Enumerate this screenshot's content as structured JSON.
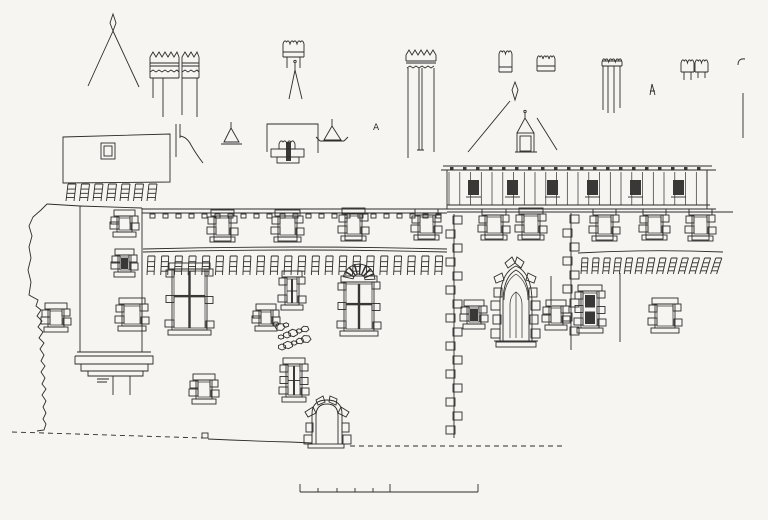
{
  "sheet": {
    "background": "#f6f5f2",
    "ink": "#2e2c2a",
    "dark": "#3a3836",
    "kind": "architectural-elevation-line-drawing"
  },
  "drawing": {
    "annotation": {
      "label": "A"
    },
    "scale_bar": {
      "y": 492,
      "x_start": 300,
      "x_end": 478,
      "major_ticks": [
        300,
        390,
        478
      ],
      "minor_ticks": [
        318,
        337,
        355,
        373
      ],
      "major_height": 8,
      "minor_height": 4
    },
    "dentils": {
      "x": 150,
      "y": 214,
      "count": 23,
      "spacing": 13,
      "w": 5,
      "h": 4
    },
    "corbel_rows": [
      {
        "name": "tower-machicolation",
        "x": 66,
        "y": 184,
        "count": 7,
        "spacing": 13.5,
        "w": 8,
        "h": 17,
        "lean": 2,
        "lean_step": 0
      },
      {
        "name": "left-machicolation",
        "x": 147,
        "y": 256,
        "count": 22,
        "spacing": 13.7,
        "w": 7,
        "h": 19,
        "lean": 1,
        "lean_step": 0
      },
      {
        "name": "right-machicolation",
        "x": 581,
        "y": 258,
        "count": 13,
        "spacing": 10.8,
        "w": 6,
        "h": 16,
        "lean": 1,
        "lean_step": 0.35
      }
    ],
    "gallery": {
      "x": 447,
      "end_x": 712,
      "top_line_1": 166,
      "top_line_2": 170,
      "post_top": 172,
      "post_bottom": 205,
      "posts": 25,
      "post_spacing": 10.75,
      "post_x0": 449,
      "bottom_line_1": 205,
      "bottom_line_2": 209,
      "sill_y": 212,
      "sill_end": 733,
      "openings_x": [
        468,
        507,
        547,
        587,
        630,
        673
      ],
      "opening_y": 180,
      "opening_w": 11,
      "opening_h": 15,
      "rafter_count": 20,
      "rafter_x0": 450,
      "rafter_spacing": 13
    },
    "windows": [
      {
        "name": "left-wall-window",
        "x": 50,
        "y": 311,
        "w": 12,
        "h": 14,
        "style": "quoin"
      },
      {
        "name": "tower-upper-window",
        "x": 119,
        "y": 218,
        "w": 11,
        "h": 12,
        "style": "quoin"
      },
      {
        "name": "tower-mid-window",
        "x": 120,
        "y": 257,
        "w": 9,
        "h": 13,
        "style": "dark"
      },
      {
        "name": "tower-lower-window",
        "x": 124,
        "y": 306,
        "w": 16,
        "h": 18,
        "style": "quoin"
      },
      {
        "name": "attic-window-1",
        "x": 216,
        "y": 218,
        "w": 13,
        "h": 17,
        "style": "attic"
      },
      {
        "name": "attic-window-2",
        "x": 280,
        "y": 218,
        "w": 15,
        "h": 17,
        "style": "attic"
      },
      {
        "name": "attic-window-3",
        "x": 347,
        "y": 216,
        "w": 13,
        "h": 18,
        "style": "attic"
      },
      {
        "name": "attic-window-4",
        "x": 420,
        "y": 217,
        "w": 13,
        "h": 16,
        "style": "attic"
      },
      {
        "name": "cross-window-west",
        "x": 174,
        "y": 271,
        "w": 31,
        "h": 57,
        "style": "cross"
      },
      {
        "name": "stacked-window",
        "x": 287,
        "y": 279,
        "w": 10,
        "h": 24,
        "style": "double2"
      },
      {
        "name": "small-window-a",
        "x": 261,
        "y": 312,
        "w": 10,
        "h": 12,
        "style": "quoin"
      },
      {
        "name": "cross-window-center",
        "x": 346,
        "y": 284,
        "w": 26,
        "h": 45,
        "style": "cross",
        "voussoirs": true
      },
      {
        "name": "small-window-b",
        "x": 198,
        "y": 382,
        "w": 12,
        "h": 15,
        "style": "quoin"
      },
      {
        "name": "stacked-window-2",
        "x": 288,
        "y": 366,
        "w": 12,
        "h": 29,
        "style": "double2"
      },
      {
        "name": "small-window-c",
        "x": 469,
        "y": 308,
        "w": 10,
        "h": 14,
        "style": "dark"
      },
      {
        "name": "right-attic-window-1",
        "x": 487,
        "y": 217,
        "w": 14,
        "h": 16,
        "style": "attic"
      },
      {
        "name": "right-attic-window-2",
        "x": 524,
        "y": 216,
        "w": 14,
        "h": 17,
        "style": "attic"
      },
      {
        "name": "right-attic-window-3",
        "x": 598,
        "y": 217,
        "w": 13,
        "h": 17,
        "style": "attic"
      },
      {
        "name": "right-attic-window-4",
        "x": 648,
        "y": 217,
        "w": 13,
        "h": 16,
        "style": "attic"
      },
      {
        "name": "right-attic-window-5",
        "x": 694,
        "y": 217,
        "w": 13,
        "h": 17,
        "style": "attic"
      },
      {
        "name": "small-window-d",
        "x": 551,
        "y": 308,
        "w": 10,
        "h": 15,
        "style": "quoin"
      },
      {
        "name": "tall-window",
        "x": 583,
        "y": 293,
        "w": 14,
        "h": 33,
        "style": "tall2"
      },
      {
        "name": "small-window-e",
        "x": 657,
        "y": 306,
        "w": 16,
        "h": 20,
        "style": "quoin"
      }
    ],
    "quoin_joints": [
      {
        "name": "wall-corner-joint",
        "x": 454,
        "y1": 214,
        "y2": 438,
        "step": 14
      },
      {
        "name": "wall-joint-2",
        "x": 571,
        "y1": 213,
        "y2": 350,
        "step": 14
      }
    ],
    "crowns": [
      {
        "name": "crown-chimney-a",
        "x": 283,
        "y": 39,
        "w": 21,
        "h": 18,
        "band": true,
        "legs": [
          [
            287,
            57,
            68
          ],
          [
            300,
            57,
            68
          ]
        ]
      },
      {
        "name": "crown-chimney-b",
        "x": 499,
        "y": 49,
        "w": 13,
        "h": 23,
        "band": true,
        "legs": []
      },
      {
        "name": "crown-chimney-c",
        "x": 537,
        "y": 54,
        "w": 18,
        "h": 17,
        "band": true,
        "legs": []
      },
      {
        "name": "crown-chimney-d1",
        "x": 681,
        "y": 58,
        "w": 13,
        "h": 14,
        "band": false,
        "legs": [
          [
            684,
            72,
            80
          ],
          [
            691,
            72,
            80
          ]
        ]
      },
      {
        "name": "crown-chimney-d2",
        "x": 695,
        "y": 58,
        "w": 13,
        "h": 14,
        "band": false,
        "legs": [
          [
            698,
            72,
            78
          ],
          [
            705,
            72,
            78
          ]
        ]
      },
      {
        "name": "chimney-pot-crown",
        "x": 279,
        "y": 139,
        "w": 16,
        "h": 10,
        "band": false,
        "legs": []
      },
      {
        "name": "three-flue-crown",
        "x": 602,
        "y": 57,
        "w": 20,
        "h": 9,
        "band": true,
        "legs": [
          [
            603,
            66,
            110
          ],
          [
            608,
            66,
            113
          ],
          [
            614,
            66,
            113
          ],
          [
            620,
            66,
            108
          ]
        ]
      }
    ],
    "rubble_patch": {
      "cx": 292,
      "cy": 337,
      "count": 13
    }
  }
}
